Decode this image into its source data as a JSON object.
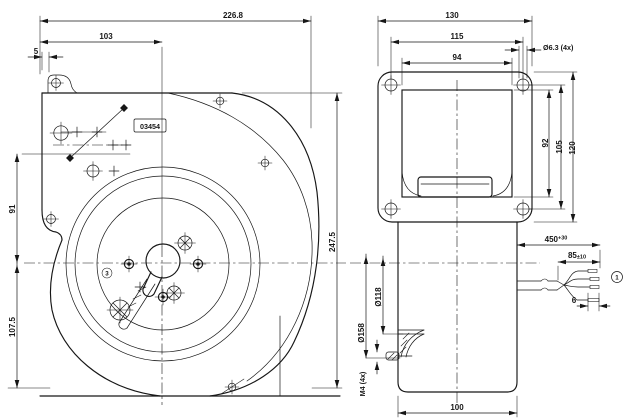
{
  "front_view": {
    "overall_width": "226.8",
    "inlet_panel_offset": "103",
    "flange_tab_offset": "5",
    "center_to_upper_hole": "91",
    "center_to_base": "107.5",
    "overall_height": "247.5",
    "stamp": "03454",
    "note_marker_3": "3"
  },
  "side_view": {
    "flange_width": "130",
    "mount_hole_pitch_horizontal": "115",
    "window_width": "94",
    "corner_hole_dia": "Ø6.3 (4x)",
    "window_height": "92",
    "mount_hole_pitch_vertical": "105",
    "flange_height": "120",
    "motor_body_width": "100",
    "inlet_inner_dia": "Ø118",
    "inlet_outer_dia": "Ø158",
    "stud_thread": "M4 (4x)"
  },
  "leads": {
    "cable_length": "450",
    "cable_length_tolerance": "+30",
    "fanout_length": "85",
    "fanout_tolerance": "±10",
    "strip_length": "6",
    "note_marker_1": "1"
  }
}
